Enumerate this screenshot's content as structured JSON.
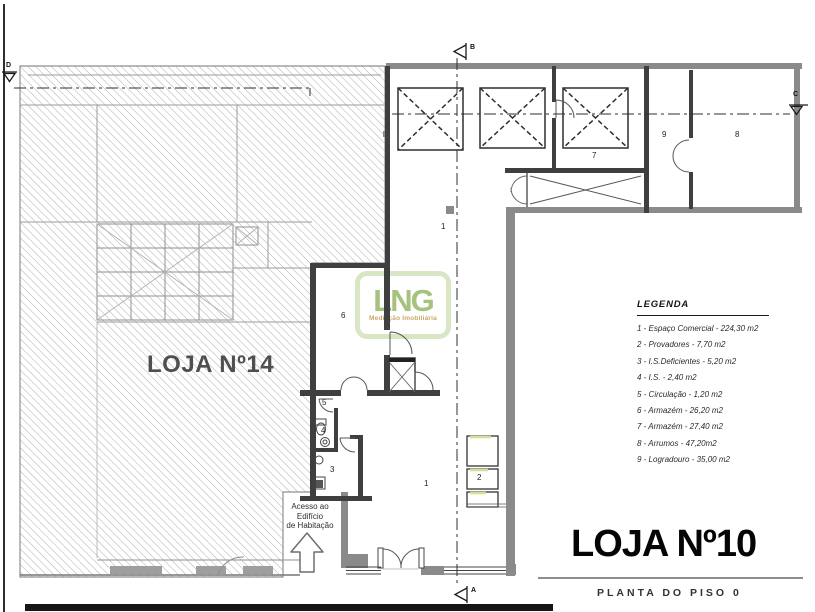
{
  "title_block": {
    "title": "LOJA Nº10",
    "subtitle": "PLANTA DO PISO 0"
  },
  "labels": {
    "neighbor": "LOJA Nº14"
  },
  "logo": {
    "name": "LNG",
    "tagline": "Mediação Imobiliária"
  },
  "legend": {
    "heading": "LEGENDA",
    "items": [
      "1 - Espaço Comercial - 224,30 m2",
      "2 - Provadores - 7,70 m2",
      "3 - I.S.Deficientes - 5,20 m2",
      "4 - I.S. - 2,40 m2",
      "5 - Circulação - 1,20 m2",
      "6 - Armazém - 26,20 m2",
      "7 - Armazém - 27,40 m2",
      "8 - Arrumos - 47,20m2",
      "9 - Logradouro - 35,00 m2"
    ]
  },
  "access_note": {
    "line1": "Acesso ao",
    "line2": "Edifício",
    "line3": "de Habitação"
  },
  "room_labels": {
    "space1_upper": "1",
    "space1_lower": "1",
    "provadores": "2",
    "is_deficientes": "3",
    "is": "4",
    "circulacao": "5",
    "armazem6": "6",
    "armazem7": "7",
    "arrumos": "8",
    "logradouro": "9"
  },
  "section_markers": {
    "a": "A",
    "b": "B",
    "c": "C",
    "d": "D"
  },
  "colors": {
    "logo_green": "#a2bf77",
    "logo_frame": "#d8e5c0",
    "logo_tagline": "#c8a45c",
    "wall_grey": "#8a8a8a",
    "wall_dark": "#3f3f3f",
    "hatch_line": "#adadad",
    "curtain_green": "#cfe29b"
  }
}
